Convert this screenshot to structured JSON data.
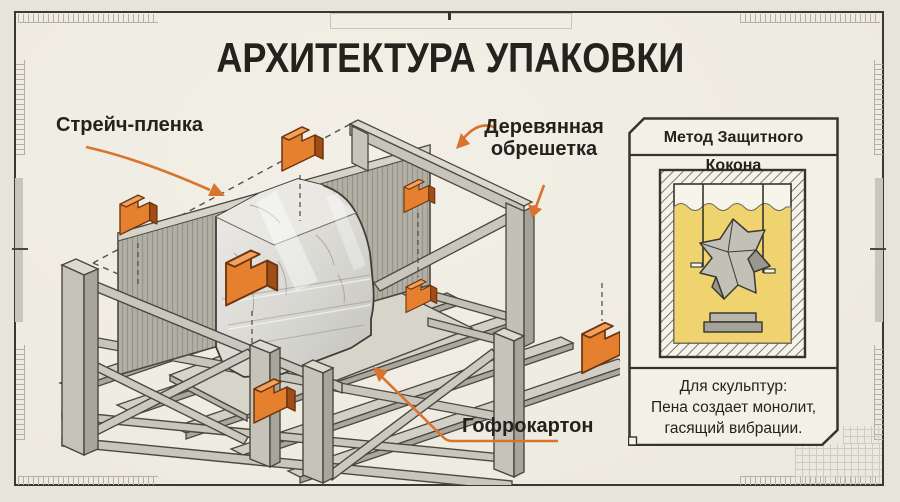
{
  "title": "АРХИТЕКТУРА УПАКОВКИ",
  "diagram": {
    "labels": {
      "stretch_film": "Стрейч-пленка",
      "wooden_crate_line1": "Деревянная",
      "wooden_crate_line2": "обрешетка",
      "cardboard": "Гофрокартон"
    },
    "parts": [
      "wooden-crate",
      "pallet",
      "wrapped-marble-block",
      "corrugated-panel",
      "corner-protectors"
    ]
  },
  "panel": {
    "title": "Метод Защитного Кокона",
    "caption_line1": "Для скульптур:",
    "caption_line2": "Пена создает монолит,",
    "caption_line3": "гасящий вибрации."
  },
  "colors": {
    "accent_orange": "#d9732e",
    "ink": "#35342e",
    "paper": "#f0ede3",
    "foam_yellow": "#eed36f",
    "wood_grey": "#c7c5bc",
    "marble": "#e0dfdb"
  }
}
